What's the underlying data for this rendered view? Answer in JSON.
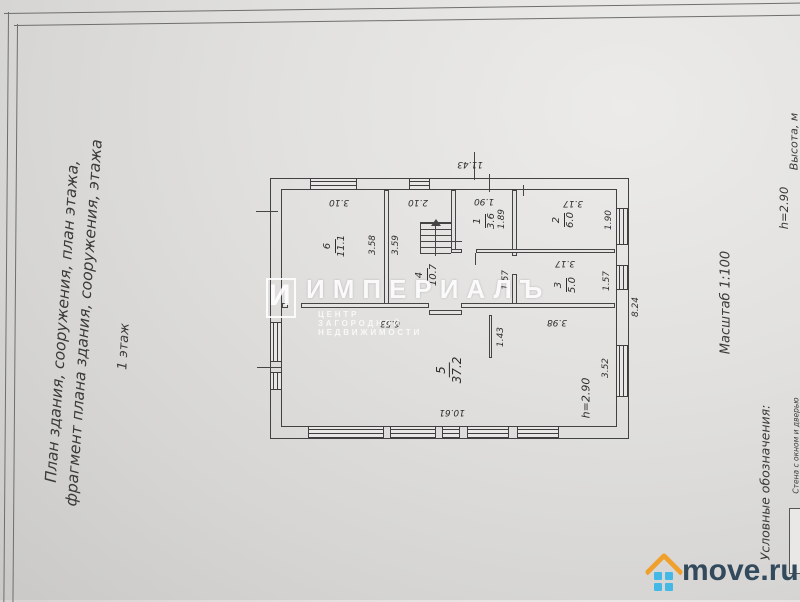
{
  "left_margin": {
    "title_line1": "План здания, сооружения, план этажа,",
    "title_line2": "фрагмент плана здания, сооружения, этажа",
    "floor_label": "1 этаж"
  },
  "right_margin": {
    "height_header": "Высота, м",
    "height_value": "h=2.90",
    "scale": "Масштаб 1:100",
    "legend_title": "Условные обозначения:",
    "legend_item": "Стена с окном и дверью"
  },
  "plan": {
    "rooms": [
      {
        "number": "1",
        "area": "3.6"
      },
      {
        "number": "2",
        "area": "6.0"
      },
      {
        "number": "3",
        "area": "5.0"
      },
      {
        "number": "4",
        "area": "10.7"
      },
      {
        "number": "5",
        "area": "37.2"
      },
      {
        "number": "6",
        "area": "11.1"
      }
    ],
    "dims": {
      "overall_top": "11.43",
      "overall_right": "8.24",
      "r6_top": "3.10",
      "r4_top": "2.10",
      "r1_top": "1.90",
      "r2_top": "3.17",
      "r3_top": "3.17",
      "r6_right": "3.58",
      "r4_left": "3.59",
      "r1_right": "1.89",
      "r2_right": "1.90",
      "r3_right": "1.57",
      "hall_width": "1.57",
      "r5_top": "6.53",
      "r5_top_right": "3.98",
      "r5_bottom": "10.61",
      "r5_right": "3.52",
      "r5_partition": "1.43",
      "r5_height": "h=2.90"
    }
  },
  "watermark": {
    "logo_letter": "И",
    "brand": "ИМПЕРИАЛЪ",
    "tagline": "ЦЕНТР ЗАГОРОДНОЙ НЕДВИЖИМОСТИ"
  },
  "site_logo": {
    "text": "move.ru",
    "roof_color": "#f0a02c",
    "squares_color": "#45b9e6",
    "text_color": "#33495c"
  }
}
